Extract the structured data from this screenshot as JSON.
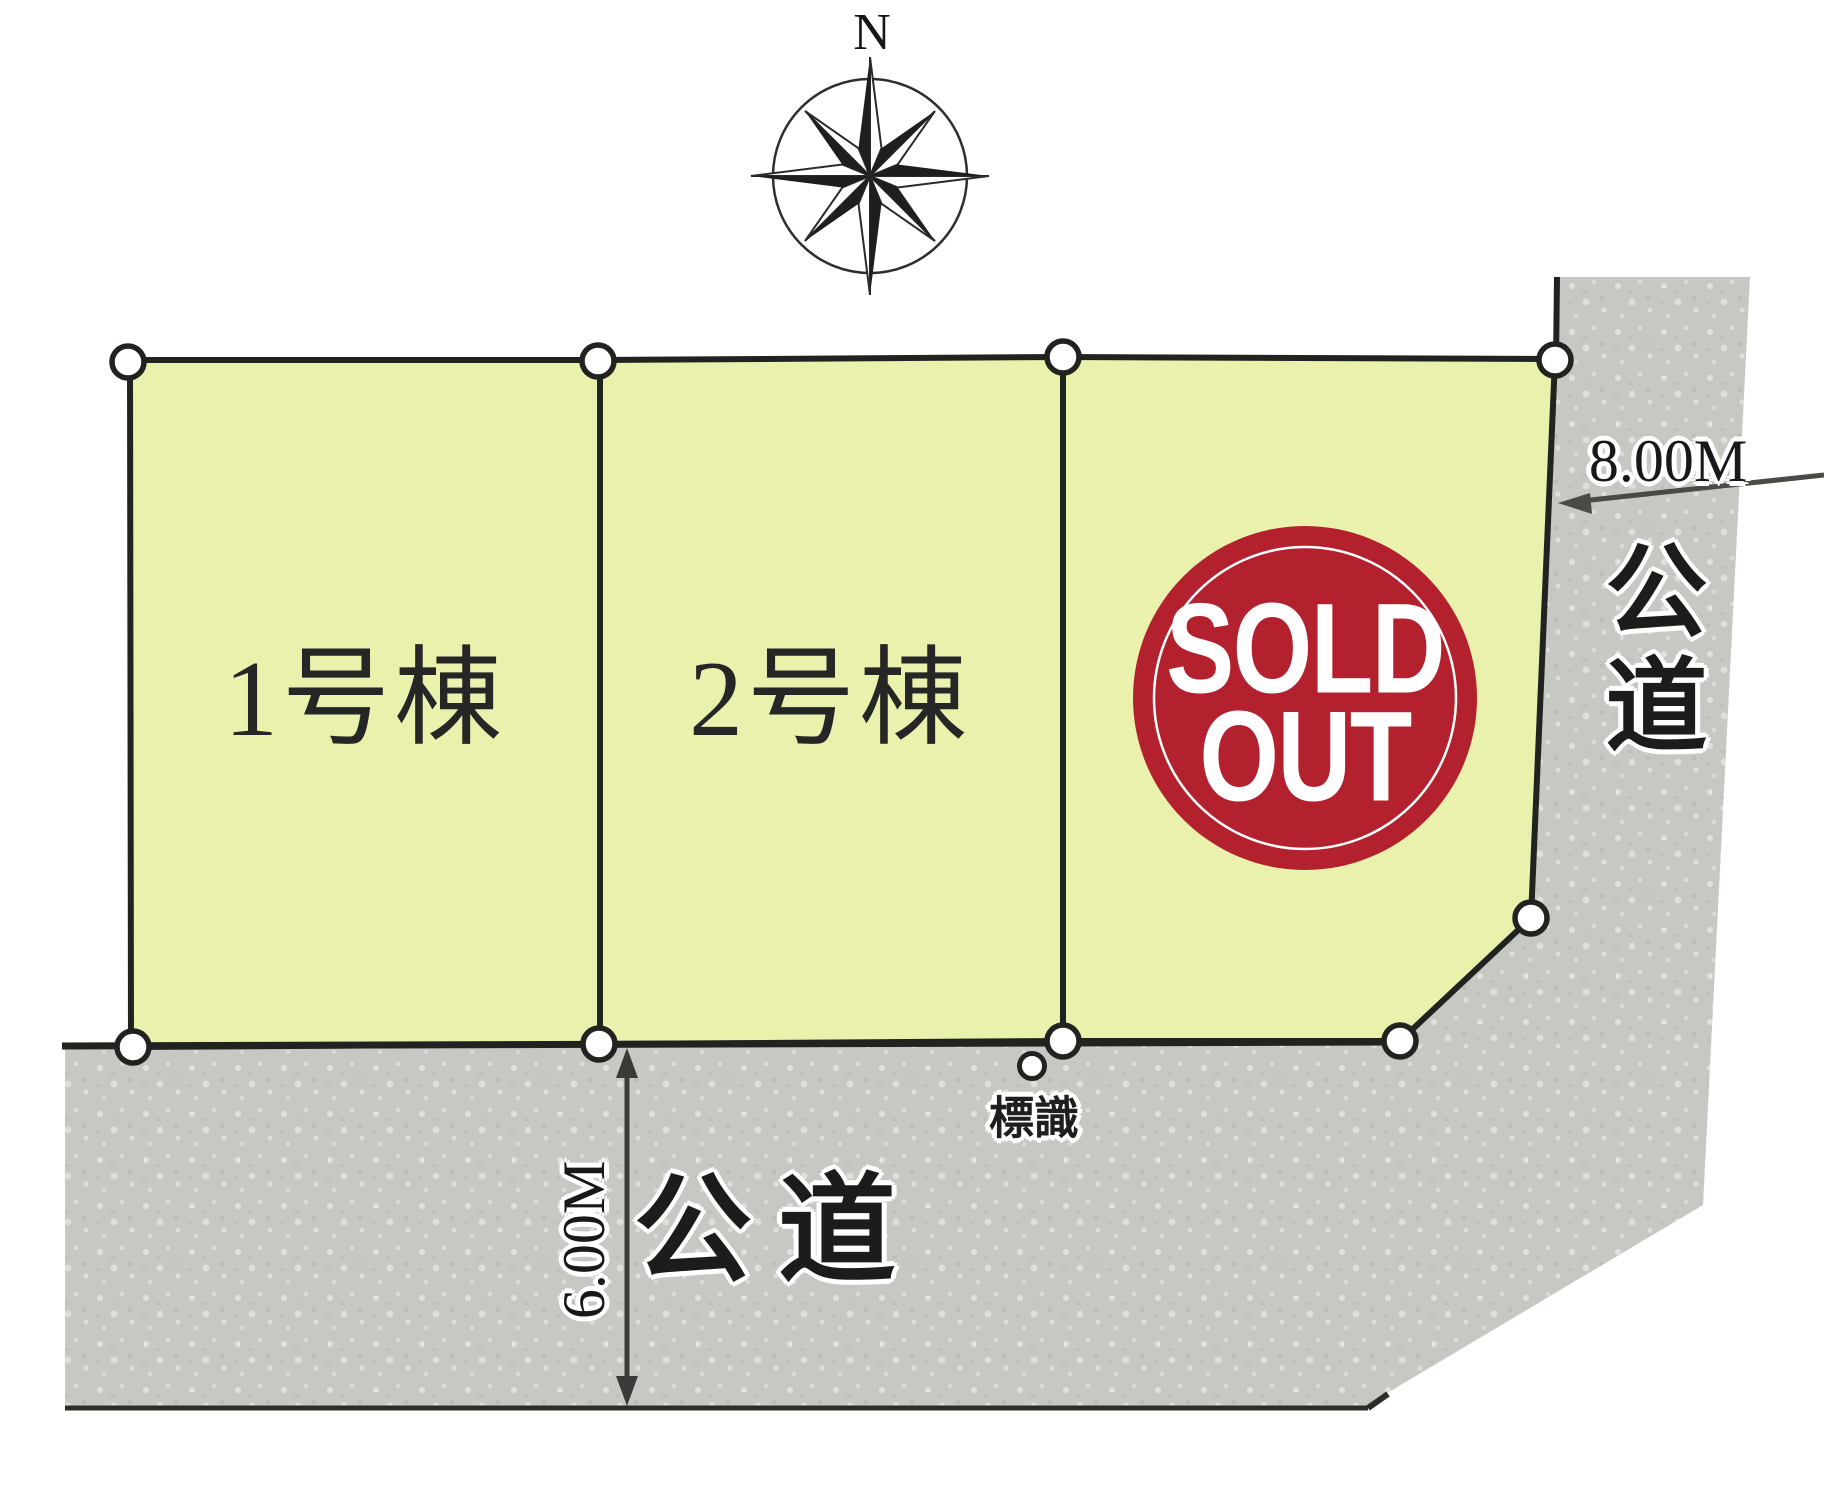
{
  "compass": {
    "north_label": "N"
  },
  "lots": [
    {
      "label": "1号棟",
      "status": "for sale"
    },
    {
      "label": "2号棟",
      "status": "for sale"
    },
    {
      "label": "",
      "status": "sold out",
      "sold_out": {
        "line1": "SOLD",
        "line2": "OUT"
      }
    }
  ],
  "roads": {
    "east": {
      "name": "公道",
      "width": "8.00M"
    },
    "south": {
      "name": "公道",
      "width": "6.00M"
    }
  },
  "markers": {
    "sign": "標識"
  },
  "colors": {
    "lot_fill": "#e9f1ad",
    "road_fill": "#c6c9c3",
    "outline": "#20231f",
    "dim_line": "#3a3a38",
    "sold_red": "#b3212e",
    "compass_ink": "#1e1e1c",
    "white": "#ffffff"
  }
}
